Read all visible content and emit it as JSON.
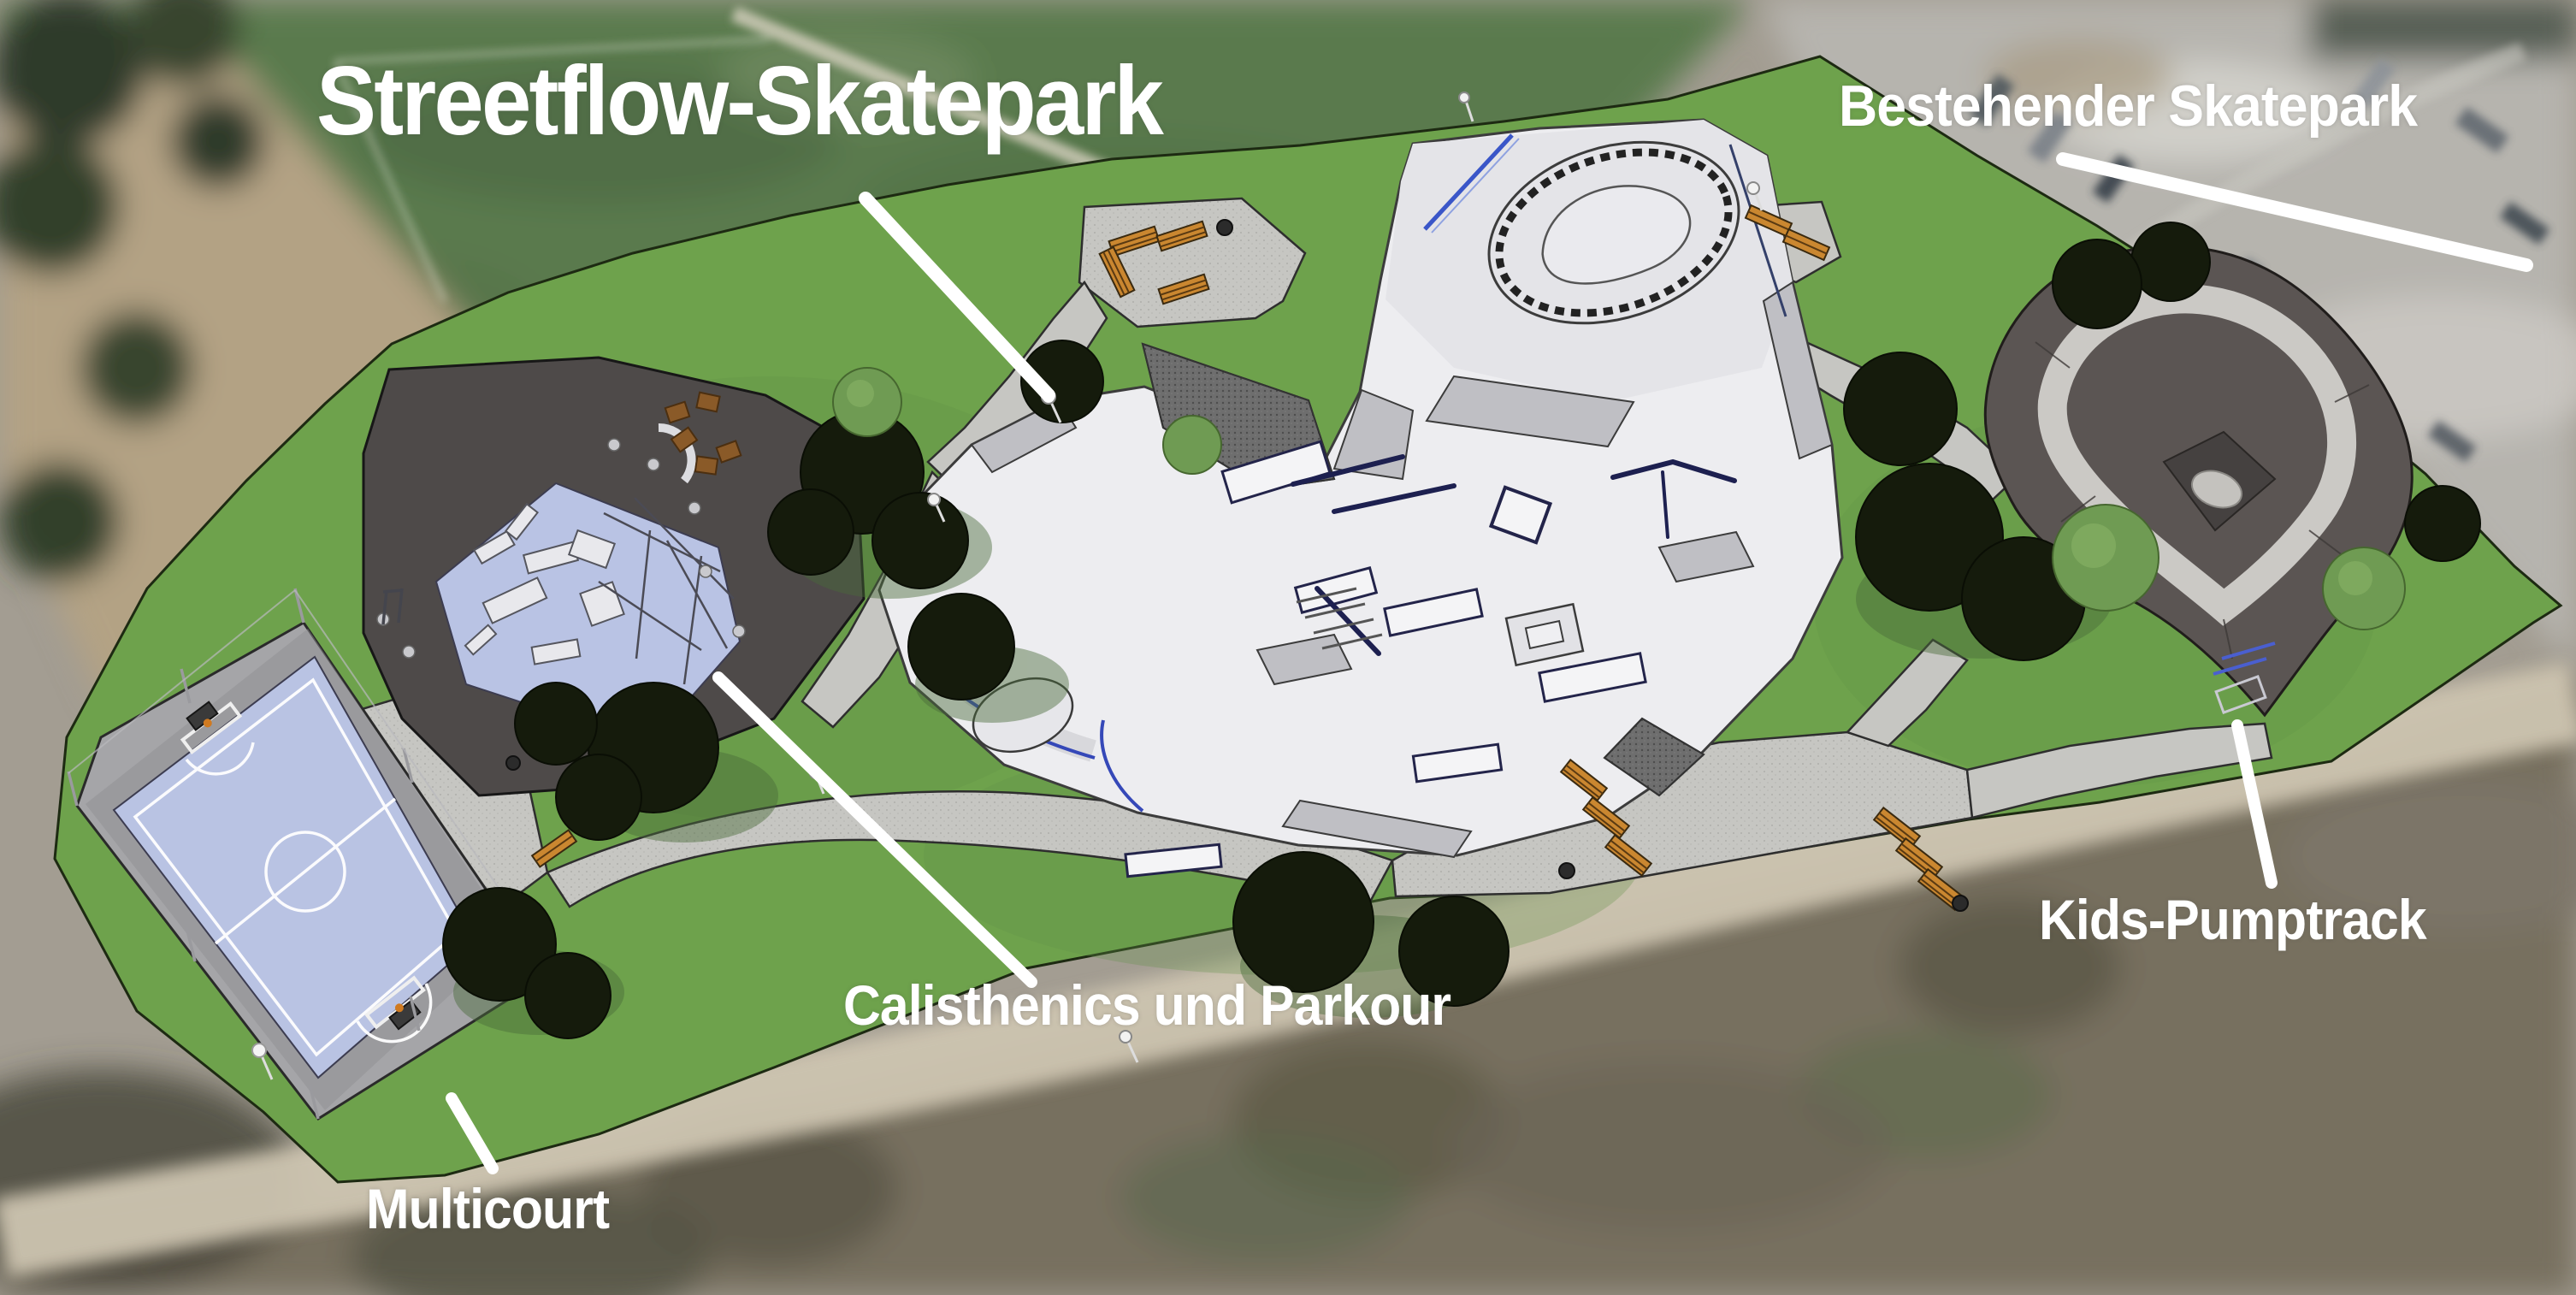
{
  "labels": {
    "title": "Streetflow-Skatepark",
    "existing_skatepark": "Bestehender Skatepark",
    "kids_pumptrack": "Kids-Pumptrack",
    "calisthenics_parkour": "Calisthenics und Parkour",
    "multicourt": "Multicourt"
  },
  "colors": {
    "label_text": "#ffffff",
    "leader_line": "#ffffff",
    "lawn": "#6ea24c",
    "concrete": "#ededf0",
    "asphalt": "#4e4a49",
    "soft_pad_blue": "#b9c3e4",
    "court_surface": "#b9c3e3",
    "pumptrack_dark": "#5b5553",
    "pumptrack_ribbon": "#cbc9c5",
    "path_gray": "#c6c6c2",
    "bench_wood": "#ca8730",
    "tree_dark": "#151b0c",
    "tree_light": "#6f9b53"
  }
}
